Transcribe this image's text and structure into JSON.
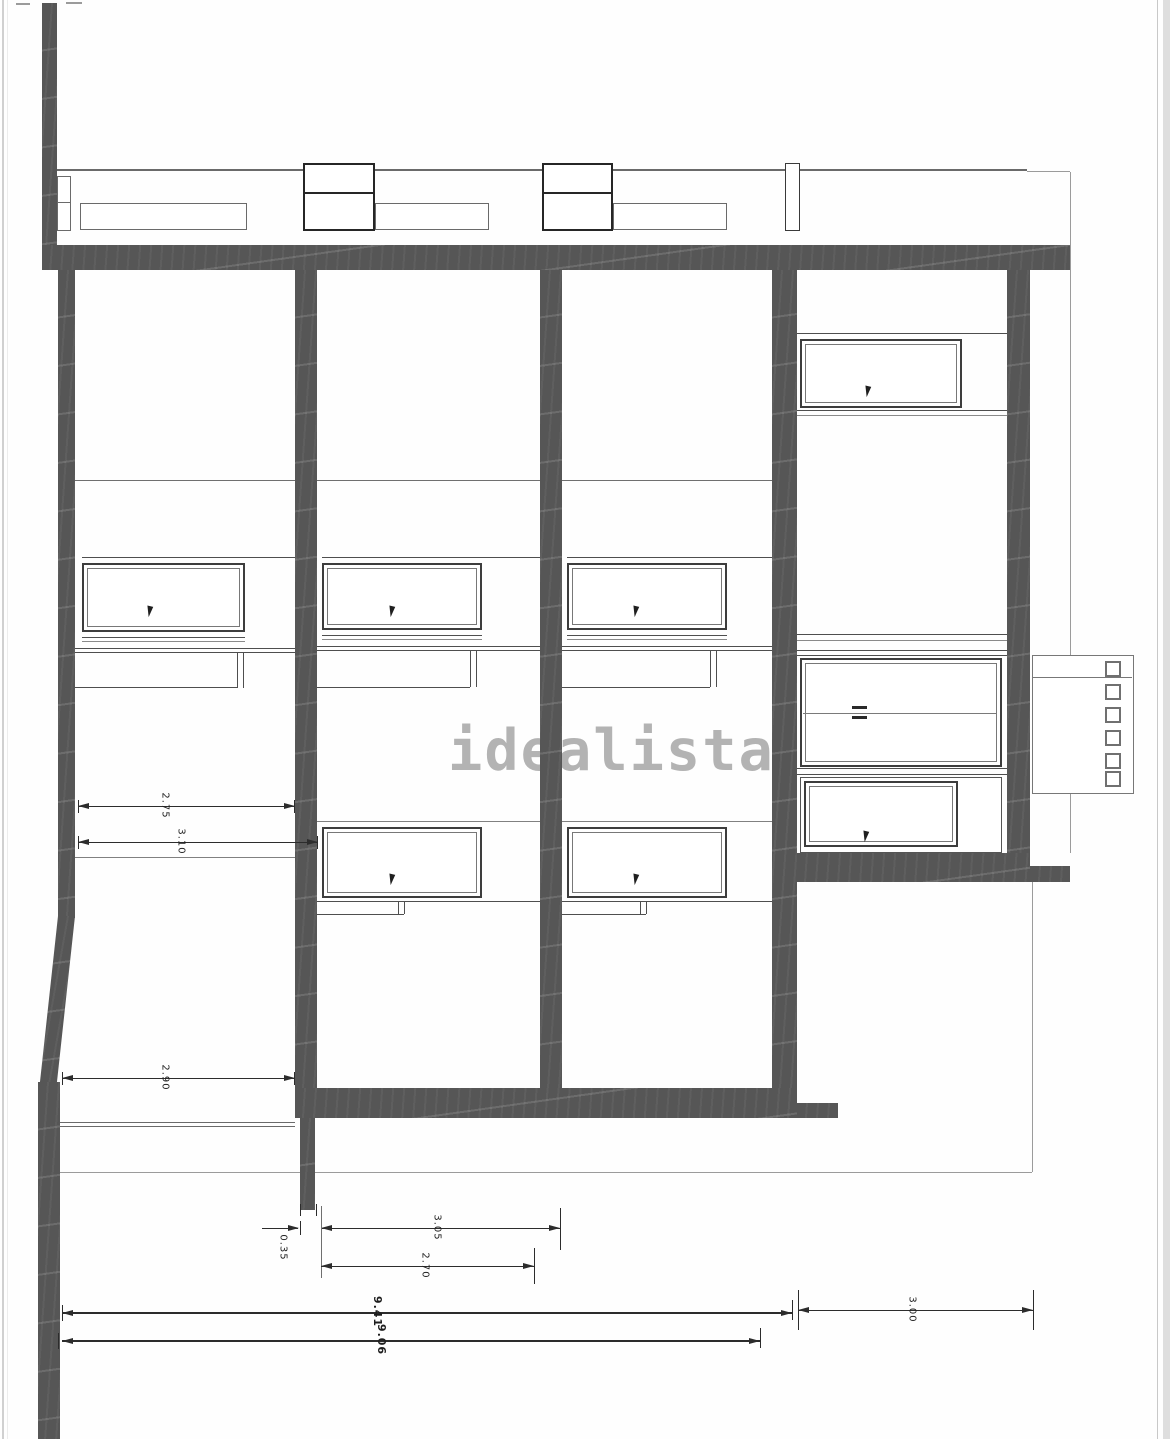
{
  "title": "architectural-section-drawing",
  "annotations": {
    "watermark": "idealista"
  },
  "dimensions": {
    "left_upper": "2.75",
    "left_mid": "3.10",
    "left_lower": "2.90",
    "stub_width": "0.35",
    "bay_outer": "3.05",
    "bay_inner": "2.70",
    "right_span": "3.00",
    "total_outer": "9.41",
    "total_inner": "9.06"
  },
  "colors": {
    "wall": "#565656",
    "dimension_line": "#2c2c2c",
    "watermark": "#b3b3b3",
    "window_frame": "#3d3d3d",
    "boundary_line": "#9b9b9b"
  },
  "icons": {
    "opening_direction": "dart-icon",
    "door_handle": "double-dash-icon"
  }
}
